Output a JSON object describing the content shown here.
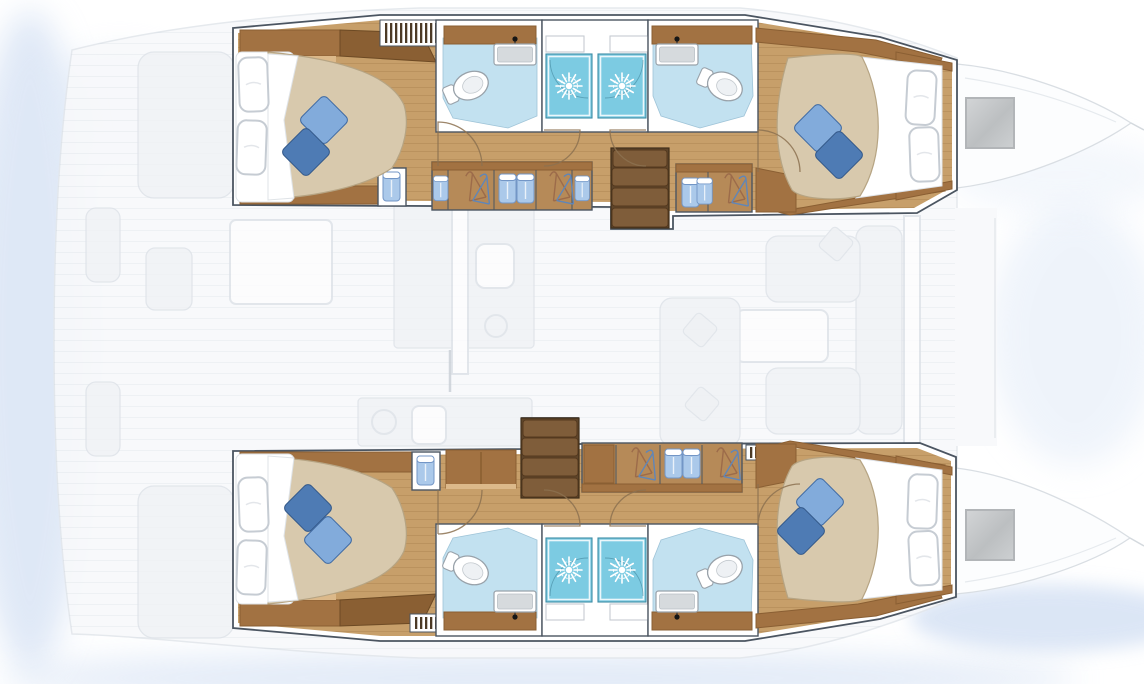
{
  "plan": {
    "vessel_type": "catamaran",
    "view": "overhead interior floor plan",
    "hulls": [
      {
        "name": "top-hull",
        "cabins": [
          {
            "name": "aft-cabin",
            "bed": "double-berth",
            "pillows": 2,
            "accent_cushions": 2
          },
          {
            "name": "forward-cabin",
            "bed": "double-berth",
            "pillows": 2,
            "accent_cushions": 2
          }
        ],
        "heads": [
          {
            "name": "aft-head",
            "fixtures": [
              "toilet",
              "sink",
              "faucet",
              "vanity-shelf"
            ]
          },
          {
            "name": "forward-head",
            "fixtures": [
              "toilet",
              "sink",
              "faucet",
              "vanity-shelf"
            ]
          }
        ],
        "showers": 2,
        "storage": [
          "wardrobe-with-hangers",
          "garment-shelves",
          "cabinets",
          "towel-locker"
        ],
        "stairs": "companionway-steps",
        "vents": 2
      },
      {
        "name": "bottom-hull",
        "cabins": [
          {
            "name": "aft-cabin",
            "bed": "double-berth",
            "pillows": 2,
            "accent_cushions": 2
          },
          {
            "name": "forward-cabin",
            "bed": "double-berth",
            "pillows": 2,
            "accent_cushions": 2
          }
        ],
        "heads": [
          {
            "name": "aft-head",
            "fixtures": [
              "toilet",
              "sink",
              "faucet",
              "vanity-shelf"
            ]
          },
          {
            "name": "forward-head",
            "fixtures": [
              "toilet",
              "sink",
              "faucet",
              "vanity-shelf"
            ]
          }
        ],
        "showers": 2,
        "storage": [
          "wardrobe-with-hangers",
          "garment-shelves",
          "cabinets",
          "towel-locker"
        ],
        "stairs": "companionway-steps",
        "vents": 2
      }
    ],
    "deck_faded_features": [
      "cockpit-benches",
      "cockpit-table",
      "helm-seat",
      "galley-counter",
      "galley-sink",
      "stove-burner",
      "saloon-sofa",
      "saloon-table",
      "chaise",
      "foredeck",
      "bow-windows"
    ]
  },
  "palette": {
    "background": "#ffffff",
    "glow": "#bfd2ee",
    "glow-soft": "#dfe9f7",
    "deck-fill": "#f8f9fb",
    "deck-stroke": "#e3e7ec",
    "deck-furniture": "#f0f2f5",
    "deck-furniture-stroke": "#dde2e8",
    "outline": "#4b5561",
    "wall": "#ffffff",
    "wood-floor": "#c79f6a",
    "wood-light": "#dcb98a",
    "wood-cabinet": "#a27242",
    "wood-dark": "#8a5f33",
    "wardrobe-interior": "#b68a58",
    "stair-wood": "#7f5d3a",
    "stair-wood-dark": "#5f452a",
    "bath-floor": "#c2e1f0",
    "shower": "#7ccbe2",
    "mattress": "#d8c9ad",
    "mattress-stroke": "#b6a483",
    "cushion-light": "#82abdb",
    "cushion-dark": "#4e7bb4",
    "sink-basin": "#d6dadd",
    "faucet": "#161616",
    "towel": "#abc9ea",
    "towel-stroke": "#7396c6",
    "hanger": "#9c6b4a",
    "hanger-blue": "#5f86b9",
    "grille-slat": "#4c3a26",
    "door-arc": "#8c7150",
    "bow-window": "#c8cacc"
  }
}
